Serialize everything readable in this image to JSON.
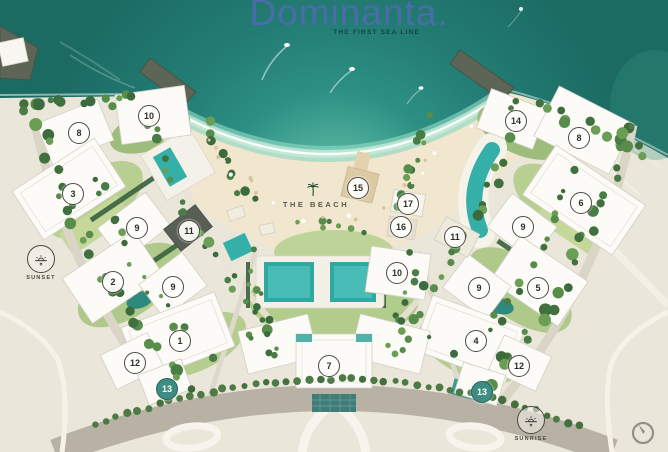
{
  "header": {
    "title": "Dominanta.",
    "tagline": "THE FIRST SEA LINE"
  },
  "map": {
    "beach_label": "THE BEACH",
    "sun_markers": [
      {
        "id": "sunset",
        "label": "SUNSET"
      },
      {
        "id": "sunrise",
        "label": "SUNRISE"
      }
    ],
    "markers": [
      {
        "label": "10",
        "x": 149,
        "y": 116,
        "variant": "default"
      },
      {
        "label": "8",
        "x": 79,
        "y": 133,
        "variant": "default"
      },
      {
        "label": "3",
        "x": 73,
        "y": 194,
        "variant": "default"
      },
      {
        "label": "9",
        "x": 137,
        "y": 228,
        "variant": "default"
      },
      {
        "label": "11",
        "x": 189,
        "y": 231,
        "variant": "default"
      },
      {
        "label": "2",
        "x": 113,
        "y": 282,
        "variant": "default"
      },
      {
        "label": "9",
        "x": 173,
        "y": 287,
        "variant": "default"
      },
      {
        "label": "1",
        "x": 180,
        "y": 341,
        "variant": "default"
      },
      {
        "label": "12",
        "x": 135,
        "y": 363,
        "variant": "default"
      },
      {
        "label": "13",
        "x": 167,
        "y": 389,
        "variant": "accent"
      },
      {
        "label": "15",
        "x": 358,
        "y": 188,
        "variant": "default"
      },
      {
        "label": "17",
        "x": 408,
        "y": 204,
        "variant": "default"
      },
      {
        "label": "16",
        "x": 401,
        "y": 227,
        "variant": "default"
      },
      {
        "label": "11",
        "x": 455,
        "y": 237,
        "variant": "default"
      },
      {
        "label": "10",
        "x": 397,
        "y": 273,
        "variant": "default"
      },
      {
        "label": "7",
        "x": 329,
        "y": 366,
        "variant": "default"
      },
      {
        "label": "14",
        "x": 516,
        "y": 121,
        "variant": "default"
      },
      {
        "label": "8",
        "x": 579,
        "y": 138,
        "variant": "default"
      },
      {
        "label": "6",
        "x": 581,
        "y": 203,
        "variant": "default"
      },
      {
        "label": "9",
        "x": 523,
        "y": 227,
        "variant": "default"
      },
      {
        "label": "5",
        "x": 538,
        "y": 288,
        "variant": "default"
      },
      {
        "label": "9",
        "x": 479,
        "y": 288,
        "variant": "default"
      },
      {
        "label": "4",
        "x": 476,
        "y": 341,
        "variant": "default"
      },
      {
        "label": "12",
        "x": 519,
        "y": 366,
        "variant": "default"
      },
      {
        "label": "13",
        "x": 482,
        "y": 392,
        "variant": "accent"
      }
    ],
    "colors": {
      "water_deep": "#1b6b63",
      "water_shallow": "#9adcc4",
      "sand": "#f1e7cf",
      "land": "#ebe6da",
      "pool": "#35b0a8",
      "accent_marker": "#3e8c82",
      "title_blue": "#4a6ca8"
    }
  }
}
